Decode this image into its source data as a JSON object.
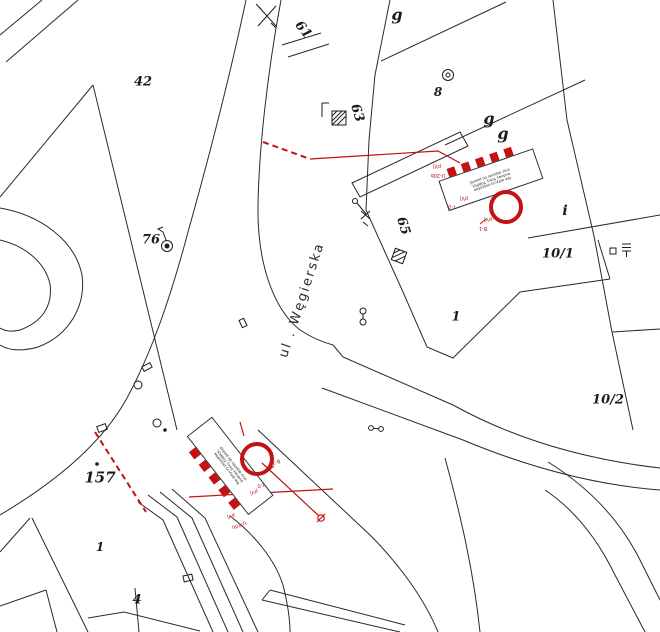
{
  "street": {
    "name": "ul . Węgierska"
  },
  "parcels": [
    {
      "id": "42"
    },
    {
      "id": "61"
    },
    {
      "id": "63"
    },
    {
      "id": "65"
    },
    {
      "id": "8"
    },
    {
      "id": "76"
    },
    {
      "id": "157"
    },
    {
      "id": "1"
    },
    {
      "id": "10/1"
    },
    {
      "id": "10/2"
    },
    {
      "id": "1"
    },
    {
      "id": "4"
    }
  ],
  "letters": [
    "g",
    "g",
    "g",
    "i"
  ],
  "signs": {
    "accent_color": "#c41111",
    "labels": {
      "pvj": "pVj",
      "u20b": "U-20b",
      "t0": "T-0",
      "b1": "B-1"
    },
    "note_lines": [
      "Nie dotyczy pojazdów",
      "budowy firmy TORPOL",
      "oraz dojazdu do posesji"
    ]
  }
}
